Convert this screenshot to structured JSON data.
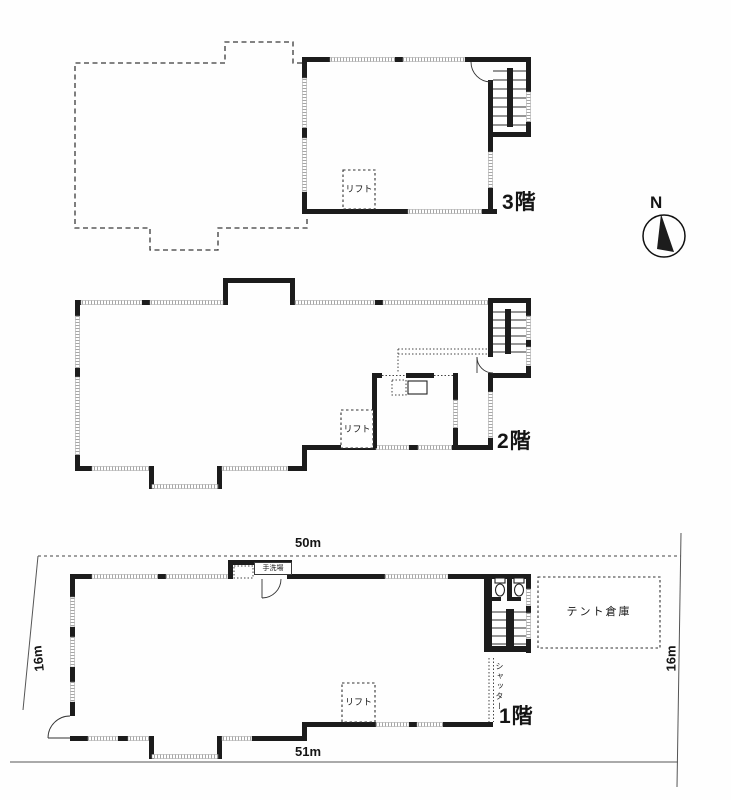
{
  "floors": {
    "f3": {
      "name": "3階",
      "lift": "リフト"
    },
    "f2": {
      "name": "2階",
      "lift": "リフト"
    },
    "f1": {
      "name": "1階",
      "lift": "リフト",
      "washroom": "手洗場",
      "shutter": "シャッター",
      "tent_storage": "テント倉庫"
    }
  },
  "dimensions": {
    "top": "50m",
    "bottom": "51m",
    "left_side": "16m",
    "right_side": "16m"
  },
  "compass": {
    "north": "N"
  },
  "colors": {
    "ink": "#1c1c1c",
    "paper": "#ffffff",
    "hatch": "#9a9a9a"
  }
}
